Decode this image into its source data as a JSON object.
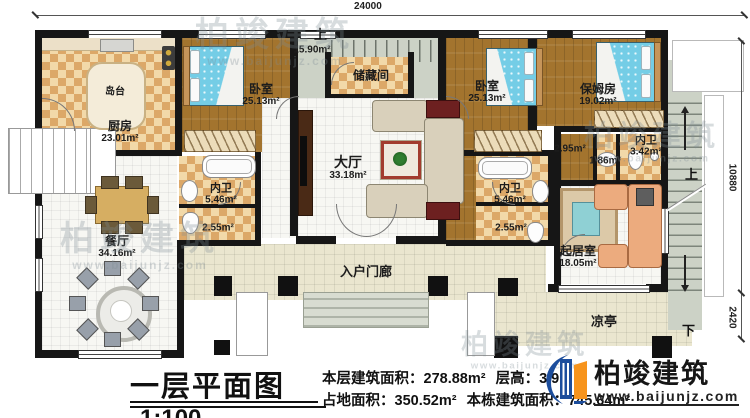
{
  "document": {
    "title": "一层平面图",
    "scale": "1:100"
  },
  "stats": {
    "s1": "本层建筑面积：278.88m²",
    "s2": "层高：3.9m",
    "s3": "占地面积：350.52m²",
    "s4": "本栋建筑面积：745.64m²"
  },
  "brand": {
    "name": "柏竣建筑",
    "url": "www.baijunjz.com"
  },
  "watermark": {
    "name": "柏竣建筑",
    "url": "www.baijunjz.com"
  },
  "dimensions": {
    "top": "24000",
    "right_main": "10880",
    "right_lower": "2420"
  },
  "rooms": {
    "kitchen": {
      "label": "厨房",
      "area": "23.01m²"
    },
    "island": {
      "label": "岛台"
    },
    "bedroom1": {
      "label": "卧室",
      "area": "25.13m²"
    },
    "bedroom2": {
      "label": "卧室",
      "area": "25.13m²"
    },
    "nanny": {
      "label": "保姆房",
      "area": "19.02m²"
    },
    "storage": {
      "label": "储藏间"
    },
    "stair_top": {
      "label": "上",
      "area": "15.90m²"
    },
    "hall": {
      "label": "大厅",
      "area": "33.18m²"
    },
    "bath1": {
      "label": "内卫",
      "area": "5.46m²"
    },
    "bath1_wc": {
      "area": "2.55m²"
    },
    "bath2": {
      "label": "内卫",
      "area": "5.46m²"
    },
    "bath2_wc": {
      "area": "2.55m²"
    },
    "nanny_hall": {
      "area": "2.95m²"
    },
    "nanny_basin": {
      "area": "1.86m²"
    },
    "nanny_bath": {
      "label": "内卫",
      "area": "3.42m²"
    },
    "dining": {
      "label": "餐厅",
      "area": "34.16m²"
    },
    "living": {
      "label": "起居室",
      "area": "18.05m²"
    },
    "porch": {
      "label": "入户门廊"
    },
    "pavilion": {
      "label": "凉亭"
    },
    "stair_right": {
      "up": "上",
      "down": "下"
    }
  },
  "colors": {
    "wall": "#161616",
    "wood_floor": "#a3742e",
    "tile": "#e7c48e",
    "bed": "#74cde6",
    "brand_blue": "#1c4d9c",
    "brand_orange": "#f7941d"
  }
}
